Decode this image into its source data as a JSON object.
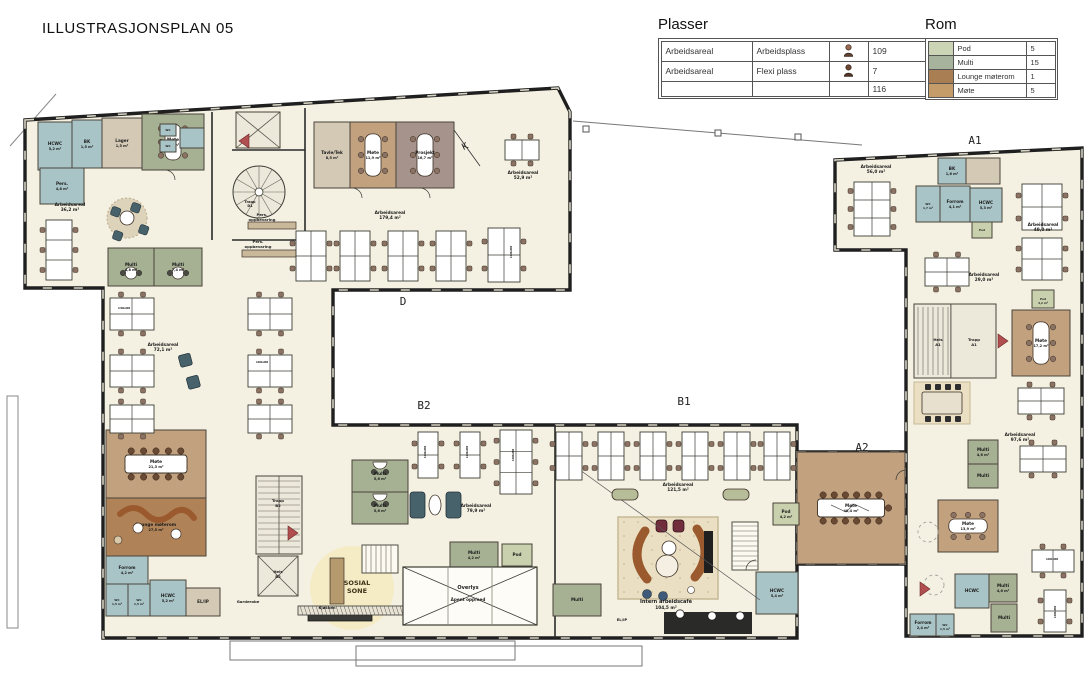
{
  "title": "ILLUSTRASJONSPLAN 05",
  "legend_plasser": {
    "title": "Plasser",
    "rows": [
      {
        "col1": "Arbeidsareal",
        "col2": "Arbeidsplass",
        "count": "109"
      },
      {
        "col1": "Arbeidsareal",
        "col2": "Flexi plass",
        "count": "7"
      },
      {
        "col1": "",
        "col2": "",
        "count": "116"
      }
    ]
  },
  "legend_rom": {
    "title": "Rom",
    "rows": [
      {
        "color": "#ccd4b6",
        "label": "Pod",
        "count": "5"
      },
      {
        "color": "#a7b39c",
        "label": "Multi",
        "count": "15"
      },
      {
        "color": "#a87e52",
        "label": "Lounge møterom",
        "count": "1"
      },
      {
        "color": "#c49c6a",
        "label": "Møte",
        "count": "5"
      }
    ]
  },
  "floorplan": {
    "colors": {
      "floor": "#f4f1e2",
      "wall": "#1f1f1f",
      "win": "#d8d4c4",
      "multi": "#a6b194",
      "pod": "#c8d0ae",
      "mote": "#c2a17f",
      "lounge": "#b08257",
      "wc": "#a9c4c6",
      "tan": "#d3c9b5",
      "mauve": "#a5938c",
      "shaft": "#ece8da",
      "carpet": "#eadfc2",
      "chair": "#8b7263",
      "teal": "#48626b",
      "red": "#b14f50",
      "sofa": "#9a5a2e",
      "armchair": "#722d3d"
    },
    "sections": [
      {
        "s": "D",
        "x": 403,
        "y": 305
      },
      {
        "s": "B2",
        "x": 424,
        "y": 409
      },
      {
        "s": "B1",
        "x": 684,
        "y": 405
      },
      {
        "s": "A1",
        "x": 975,
        "y": 144
      },
      {
        "s": "A2",
        "x": 862,
        "y": 451
      }
    ],
    "rooms": [
      {
        "x": 38,
        "y": 122,
        "w": 34,
        "h": 48,
        "t": "wc",
        "l": "HCWC",
        "a": "5,2 m²"
      },
      {
        "x": 72,
        "y": 120,
        "w": 30,
        "h": 48,
        "t": "wc",
        "l": "BK",
        "a": "1,5 m²"
      },
      {
        "x": 102,
        "y": 118,
        "w": 40,
        "h": 50,
        "t": "tan",
        "l": "Lager",
        "a": "1,5 m²"
      },
      {
        "x": 142,
        "y": 114,
        "w": 62,
        "h": 56,
        "t": "multi",
        "l": "Møte",
        "a": "6,8 m²",
        "tb": "table-v"
      },
      {
        "x": 40,
        "y": 168,
        "w": 44,
        "h": 36,
        "t": "wc",
        "l": "Pers.",
        "a": "4,8 m²"
      },
      {
        "x": 160,
        "y": 124,
        "w": 16,
        "h": 12,
        "t": "wc",
        "l": "WC"
      },
      {
        "x": 160,
        "y": 140,
        "w": 16,
        "h": 12,
        "t": "wc",
        "l": "WC"
      },
      {
        "x": 180,
        "y": 128,
        "w": 24,
        "h": 20,
        "t": "wc",
        "l": ""
      },
      {
        "x": 108,
        "y": 248,
        "w": 46,
        "h": 38,
        "t": "multi",
        "l": "Multi",
        "a": "4,8 m²",
        "tb": "round-sm"
      },
      {
        "x": 154,
        "y": 248,
        "w": 48,
        "h": 38,
        "t": "multi",
        "l": "Multi",
        "a": "7,4 m²",
        "tb": "round-sm"
      },
      {
        "x": 236,
        "y": 112,
        "w": 44,
        "h": 36,
        "t": "shaft",
        "cross": true
      },
      {
        "x": 314,
        "y": 122,
        "w": 36,
        "h": 66,
        "t": "tan",
        "l": "Tavle/Tek",
        "a": "8,5 m²"
      },
      {
        "x": 350,
        "y": 122,
        "w": 46,
        "h": 66,
        "t": "mote",
        "l": "Møte",
        "a": "11,9 m²",
        "tb": "table-v"
      },
      {
        "x": 396,
        "y": 122,
        "w": 58,
        "h": 66,
        "t": "mauve",
        "l": "Prosjekt",
        "a": "16,7 m²",
        "tb": "table-v"
      },
      {
        "x": 938,
        "y": 158,
        "w": 28,
        "h": 26,
        "t": "wc",
        "l": "BK",
        "a": "1,6 m²"
      },
      {
        "x": 966,
        "y": 158,
        "w": 34,
        "h": 26,
        "t": "tan",
        "l": ""
      },
      {
        "x": 916,
        "y": 186,
        "w": 24,
        "h": 36,
        "t": "wc",
        "l": "WC",
        "a": "1,7 m²"
      },
      {
        "x": 940,
        "y": 186,
        "w": 30,
        "h": 36,
        "t": "wc",
        "l": "Forrom",
        "a": "4,1 m²"
      },
      {
        "x": 970,
        "y": 188,
        "w": 32,
        "h": 34,
        "t": "wc",
        "l": "HCWC",
        "a": "5,3 m²"
      },
      {
        "x": 972,
        "y": 222,
        "w": 20,
        "h": 16,
        "t": "pod",
        "l": "Pod"
      },
      {
        "x": 1032,
        "y": 290,
        "w": 22,
        "h": 18,
        "t": "pod",
        "l": "Pod",
        "a": "4,2 m²"
      },
      {
        "x": 1012,
        "y": 310,
        "w": 58,
        "h": 66,
        "t": "mote",
        "l": "Møte",
        "a": "17,2 m²",
        "tb": "table-v"
      },
      {
        "x": 914,
        "y": 304,
        "w": 82,
        "h": 74,
        "t": "shaft",
        "stairH": true
      },
      {
        "x": 968,
        "y": 440,
        "w": 30,
        "h": 24,
        "t": "multi",
        "l": "Multi",
        "a": "4,6 m²"
      },
      {
        "x": 968,
        "y": 464,
        "w": 30,
        "h": 24,
        "t": "multi",
        "l": "Multi"
      },
      {
        "x": 938,
        "y": 500,
        "w": 60,
        "h": 52,
        "t": "mote",
        "l": "Møte",
        "a": "13,9 m²",
        "tb": "table-h"
      },
      {
        "x": 955,
        "y": 574,
        "w": 34,
        "h": 34,
        "t": "wc",
        "l": "HCWC"
      },
      {
        "x": 989,
        "y": 574,
        "w": 28,
        "h": 28,
        "t": "multi",
        "l": "Multi",
        "a": "4,6 m²"
      },
      {
        "x": 991,
        "y": 604,
        "w": 26,
        "h": 28,
        "t": "multi",
        "l": "Multi"
      },
      {
        "x": 910,
        "y": 614,
        "w": 26,
        "h": 22,
        "t": "wc",
        "l": "Forrom",
        "a": "2,4 m²"
      },
      {
        "x": 936,
        "y": 614,
        "w": 18,
        "h": 22,
        "t": "wc",
        "l": "WC",
        "a": "1,5 m²"
      },
      {
        "x": 797,
        "y": 452,
        "w": 108,
        "h": 112,
        "t": "mote",
        "l": "Møte",
        "a": "40,4 m²",
        "tb": "conference"
      },
      {
        "x": 106,
        "y": 430,
        "w": 100,
        "h": 68,
        "t": "mote",
        "l": "Møte",
        "a": "21,3 m²",
        "tb": "conference-sm"
      },
      {
        "x": 106,
        "y": 498,
        "w": 100,
        "h": 58,
        "t": "lounge",
        "l": "Lounge møterom",
        "a": "27,5 m²"
      },
      {
        "x": 106,
        "y": 556,
        "w": 42,
        "h": 28,
        "t": "wc",
        "l": "Forrom",
        "a": "4,2 m²"
      },
      {
        "x": 106,
        "y": 584,
        "w": 22,
        "h": 32,
        "t": "wc",
        "l": "WC",
        "a": "1,5 m²"
      },
      {
        "x": 128,
        "y": 584,
        "w": 22,
        "h": 32,
        "t": "wc",
        "l": "WC",
        "a": "1,5 m²"
      },
      {
        "x": 150,
        "y": 580,
        "w": 36,
        "h": 36,
        "t": "wc",
        "l": "HCWC",
        "a": "5,2 m²"
      },
      {
        "x": 186,
        "y": 588,
        "w": 34,
        "h": 28,
        "t": "tan",
        "l": "EL/IP"
      },
      {
        "x": 256,
        "y": 476,
        "w": 46,
        "h": 78,
        "t": "shaft",
        "stairV": true
      },
      {
        "x": 258,
        "y": 556,
        "w": 40,
        "h": 40,
        "t": "shaft",
        "cross": true
      },
      {
        "x": 352,
        "y": 460,
        "w": 56,
        "h": 32,
        "t": "multi",
        "l": "Multi",
        "a": "5,6 m²",
        "tb": "half"
      },
      {
        "x": 352,
        "y": 492,
        "w": 56,
        "h": 32,
        "t": "multi",
        "l": "Multi",
        "a": "5,6 m²",
        "tb": "half"
      },
      {
        "x": 450,
        "y": 542,
        "w": 48,
        "h": 26,
        "t": "multi",
        "l": "Multi",
        "a": "4,2 m²"
      },
      {
        "x": 502,
        "y": 544,
        "w": 30,
        "h": 22,
        "t": "pod",
        "l": "Pod"
      },
      {
        "x": 553,
        "y": 584,
        "w": 48,
        "h": 32,
        "t": "multi",
        "l": "Multi"
      },
      {
        "x": 756,
        "y": 572,
        "w": 42,
        "h": 42,
        "t": "wc",
        "l": "HCWC",
        "a": "5,4 m²"
      },
      {
        "x": 773,
        "y": 503,
        "w": 26,
        "h": 22,
        "t": "pod",
        "l": "Pod",
        "a": "4,2 m²"
      }
    ],
    "desks": [
      {
        "x": 296,
        "y": 231,
        "w": 30,
        "h": 50,
        "dx": 2,
        "dy": 2,
        "ch": "lr"
      },
      {
        "x": 340,
        "y": 231,
        "w": 30,
        "h": 50,
        "dx": 2,
        "dy": 2,
        "ch": "lr"
      },
      {
        "x": 388,
        "y": 231,
        "w": 30,
        "h": 50,
        "dx": 2,
        "dy": 2,
        "ch": "lr"
      },
      {
        "x": 436,
        "y": 231,
        "w": 30,
        "h": 50,
        "dx": 2,
        "dy": 2,
        "ch": "lr"
      },
      {
        "x": 488,
        "y": 228,
        "w": 32,
        "h": 54,
        "dx": 2,
        "dy": 2,
        "ch": "lr"
      },
      {
        "x": 505,
        "y": 140,
        "w": 34,
        "h": 20,
        "dx": 2,
        "dy": 1,
        "ch": "tb"
      },
      {
        "x": 46,
        "y": 220,
        "w": 26,
        "h": 60,
        "dx": 1,
        "dy": 3,
        "ch": "lr"
      },
      {
        "x": 854,
        "y": 182,
        "w": 36,
        "h": 54,
        "dx": 2,
        "dy": 3,
        "ch": "lr"
      },
      {
        "x": 1022,
        "y": 184,
        "w": 40,
        "h": 46,
        "dx": 2,
        "dy": 2,
        "ch": "lr"
      },
      {
        "x": 1022,
        "y": 238,
        "w": 40,
        "h": 42,
        "dx": 2,
        "dy": 2,
        "ch": "lr"
      },
      {
        "x": 925,
        "y": 258,
        "w": 44,
        "h": 28,
        "dx": 2,
        "dy": 2,
        "ch": "tb"
      },
      {
        "x": 1018,
        "y": 388,
        "w": 46,
        "h": 26,
        "dx": 2,
        "dy": 2,
        "ch": "tb"
      },
      {
        "x": 1020,
        "y": 446,
        "w": 46,
        "h": 26,
        "dx": 2,
        "dy": 2,
        "ch": "tb"
      },
      {
        "x": 1032,
        "y": 550,
        "w": 42,
        "h": 22,
        "dx": 2,
        "dy": 1,
        "ch": "tb"
      },
      {
        "x": 1044,
        "y": 590,
        "w": 22,
        "h": 42,
        "dx": 1,
        "dy": 2,
        "ch": "lr"
      },
      {
        "x": 110,
        "y": 298,
        "w": 44,
        "h": 32,
        "dx": 2,
        "dy": 2,
        "ch": "tb"
      },
      {
        "x": 110,
        "y": 355,
        "w": 44,
        "h": 32,
        "dx": 2,
        "dy": 2,
        "ch": "tb"
      },
      {
        "x": 110,
        "y": 405,
        "w": 44,
        "h": 28,
        "dx": 2,
        "dy": 2,
        "ch": "tb"
      },
      {
        "x": 248,
        "y": 298,
        "w": 44,
        "h": 32,
        "dx": 2,
        "dy": 2,
        "ch": "tb"
      },
      {
        "x": 248,
        "y": 355,
        "w": 44,
        "h": 32,
        "dx": 2,
        "dy": 2,
        "ch": "tb"
      },
      {
        "x": 248,
        "y": 405,
        "w": 44,
        "h": 28,
        "dx": 2,
        "dy": 2,
        "ch": "tb"
      },
      {
        "x": 418,
        "y": 432,
        "w": 20,
        "h": 46,
        "dx": 1,
        "dy": 2,
        "ch": "lr"
      },
      {
        "x": 460,
        "y": 432,
        "w": 20,
        "h": 46,
        "dx": 1,
        "dy": 2,
        "ch": "lr"
      },
      {
        "x": 500,
        "y": 430,
        "w": 32,
        "h": 64,
        "dx": 2,
        "dy": 3,
        "ch": "lr"
      },
      {
        "x": 556,
        "y": 432,
        "w": 26,
        "h": 48,
        "dx": 2,
        "dy": 2,
        "ch": "lr"
      },
      {
        "x": 598,
        "y": 432,
        "w": 26,
        "h": 48,
        "dx": 2,
        "dy": 2,
        "ch": "lr"
      },
      {
        "x": 640,
        "y": 432,
        "w": 26,
        "h": 48,
        "dx": 2,
        "dy": 2,
        "ch": "lr"
      },
      {
        "x": 682,
        "y": 432,
        "w": 26,
        "h": 48,
        "dx": 2,
        "dy": 2,
        "ch": "lr"
      },
      {
        "x": 724,
        "y": 432,
        "w": 26,
        "h": 48,
        "dx": 2,
        "dy": 2,
        "ch": "lr"
      },
      {
        "x": 764,
        "y": 432,
        "w": 26,
        "h": 48,
        "dx": 2,
        "dy": 2,
        "ch": "lr"
      }
    ],
    "labels": [
      {
        "x": 70,
        "y": 206,
        "s": "Arbeidsareal"
      },
      {
        "x": 70,
        "y": 211,
        "s": "36,2 m²"
      },
      {
        "x": 390,
        "y": 214,
        "s": "Arbeidsareal"
      },
      {
        "x": 390,
        "y": 219,
        "s": "179,4 m²"
      },
      {
        "x": 523,
        "y": 174,
        "s": "Arbeidsareal"
      },
      {
        "x": 523,
        "y": 179,
        "s": "52,9 m²"
      },
      {
        "x": 163,
        "y": 346,
        "s": "Arbeidsareal"
      },
      {
        "x": 163,
        "y": 351,
        "s": "72,1 m²"
      },
      {
        "x": 476,
        "y": 507,
        "s": "Arbeidsareal"
      },
      {
        "x": 476,
        "y": 512,
        "s": "79,9 m²"
      },
      {
        "x": 678,
        "y": 486,
        "s": "Arbeidsareal"
      },
      {
        "x": 678,
        "y": 491,
        "s": "121,5 m²"
      },
      {
        "x": 666,
        "y": 603,
        "s": "Intern arbeidscafé",
        "f": 5
      },
      {
        "x": 666,
        "y": 609,
        "s": "104,5 m²"
      },
      {
        "x": 876,
        "y": 168,
        "s": "Arbeidsareal"
      },
      {
        "x": 876,
        "y": 173,
        "s": "56,0 m²"
      },
      {
        "x": 1043,
        "y": 226,
        "s": "Arbeidsareal"
      },
      {
        "x": 1043,
        "y": 231,
        "s": "49,0 m²"
      },
      {
        "x": 984,
        "y": 276,
        "s": "Arbeidsareal"
      },
      {
        "x": 984,
        "y": 281,
        "s": "29,0 m²"
      },
      {
        "x": 1020,
        "y": 436,
        "s": "Arbeidsareal"
      },
      {
        "x": 1020,
        "y": 441,
        "s": "97,6 m²"
      },
      {
        "x": 262,
        "y": 216,
        "s": "Pers.",
        "f": 3.8
      },
      {
        "x": 262,
        "y": 221,
        "s": "oppbevaring",
        "f": 3.8
      },
      {
        "x": 258,
        "y": 243,
        "s": "Pers.",
        "f": 3.8
      },
      {
        "x": 258,
        "y": 248,
        "s": "oppbevaring",
        "f": 3.8
      },
      {
        "x": 357,
        "y": 585,
        "s": "SOSIAL",
        "f": 6.5,
        "c": "#3f3318"
      },
      {
        "x": 357,
        "y": 593,
        "s": "SONE",
        "f": 6.5,
        "c": "#3f3318"
      },
      {
        "x": 327,
        "y": 609,
        "s": "Kjøkken",
        "f": 3.8
      },
      {
        "x": 248,
        "y": 603,
        "s": "Garderobe",
        "f": 3.8
      },
      {
        "x": 468,
        "y": 589,
        "s": "Overlys",
        "f": 5
      },
      {
        "x": 468,
        "y": 601,
        "s": "Åpent opp/ned",
        "f": 4.2
      },
      {
        "x": 938,
        "y": 341,
        "s": "Heis",
        "f": 3.8
      },
      {
        "x": 938,
        "y": 346,
        "s": "A1",
        "f": 3.8
      },
      {
        "x": 974,
        "y": 341,
        "s": "Trapp",
        "f": 3.8
      },
      {
        "x": 974,
        "y": 346,
        "s": "A1",
        "f": 3.8
      },
      {
        "x": 278,
        "y": 502,
        "s": "Trapp",
        "f": 3.8
      },
      {
        "x": 278,
        "y": 507,
        "s": "B2",
        "f": 3.8
      },
      {
        "x": 278,
        "y": 573,
        "s": "Heis",
        "f": 3.8
      },
      {
        "x": 278,
        "y": 578,
        "s": "B2",
        "f": 3.8
      },
      {
        "x": 250,
        "y": 203,
        "s": "Trapp",
        "f": 3.5
      },
      {
        "x": 250,
        "y": 207,
        "s": "D1",
        "f": 3.5
      },
      {
        "x": 622,
        "y": 621,
        "s": "EL/IP",
        "f": 3.8
      },
      {
        "x": 124,
        "y": 309,
        "s": "140x80",
        "f": 3
      },
      {
        "x": 262,
        "y": 363,
        "s": "160x80",
        "f": 3
      },
      {
        "x": 426,
        "y": 452,
        "s": "160x80",
        "f": 3,
        "r": -90
      },
      {
        "x": 468,
        "y": 452,
        "s": "160x80",
        "f": 3,
        "r": -90
      },
      {
        "x": 514,
        "y": 455,
        "s": "160x80",
        "f": 3,
        "r": -90
      },
      {
        "x": 512,
        "y": 252,
        "s": "160x80",
        "f": 3,
        "r": -90
      },
      {
        "x": 1052,
        "y": 560,
        "s": "160x80",
        "f": 3
      },
      {
        "x": 1056,
        "y": 612,
        "s": "160x80",
        "f": 3,
        "r": -90
      },
      {
        "x": 466,
        "y": 149,
        "s": "K",
        "f": 9,
        "w": 400,
        "r": -25
      }
    ]
  }
}
